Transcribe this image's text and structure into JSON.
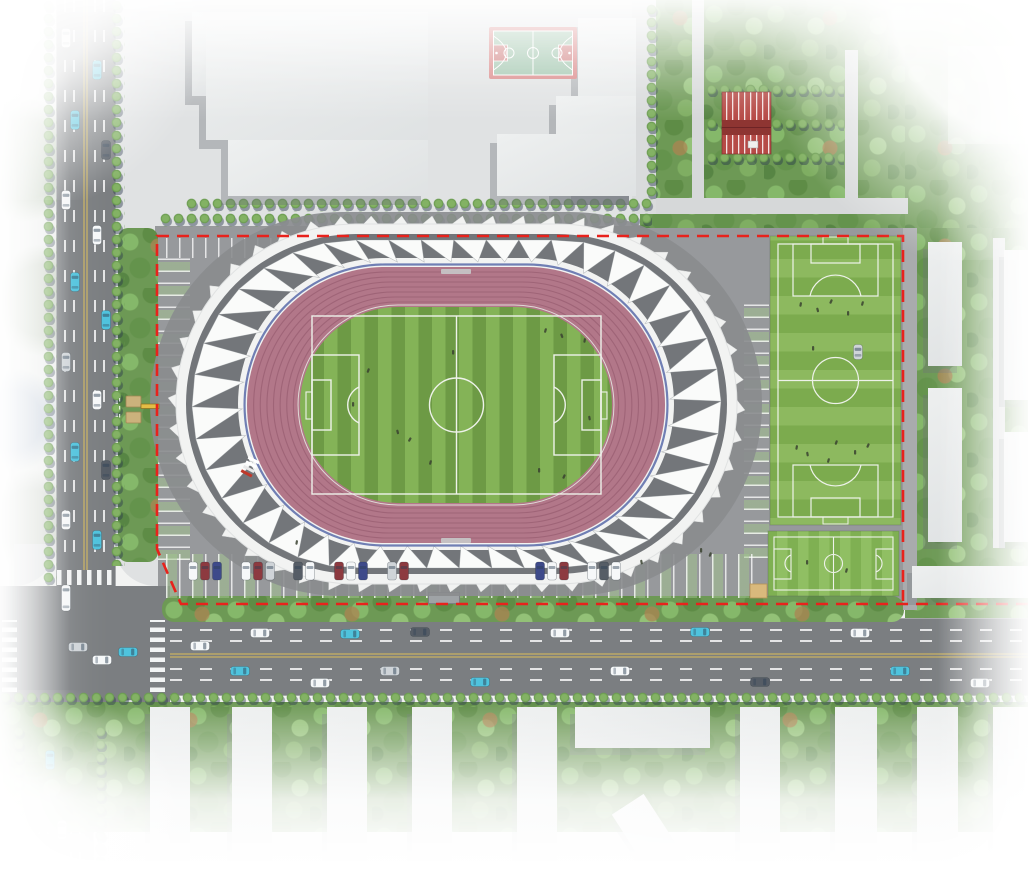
{
  "scene": {
    "type": "aerial-site-plan-rendering",
    "subject": "stadium sports complex with running track, practice pitches and surrounding streets",
    "visible_text": []
  },
  "colors": {
    "boundary_red": "#e8221c",
    "roof_white": "#f2f3f2",
    "roof_pleat": "#fafbfa",
    "roof_shadow": "#73767a",
    "stadium_surround": "#898c8e",
    "track_rose": "#b27789",
    "track_lane_line": "#9a5f73",
    "track_blue_edge": "#44589f",
    "field_green_light": "#84b357",
    "field_green_dark": "#6d9a45",
    "pitch_line_white": "#eef2ea",
    "practice_light": "#8db95f",
    "practice_dark": "#7cab4e",
    "small_field_light": "#90bf63",
    "small_field_dark": "#7fb052",
    "court_border_red": "#d98484",
    "court_surface_green": "#9ec4ab",
    "court_key_red": "#cf7d7d",
    "stand_red": "#b64a46",
    "stand_red_dark": "#8e3532",
    "road_asphalt": "#7b7e81",
    "plaza_gray": "#e0e2e3",
    "site_pavement": "#97999c",
    "building_gray": "#e9ebec",
    "median_yellow": "#ac9e6d",
    "car_cyan": "#4fc3dd",
    "car_white": "#f6f8f9",
    "car_dark": "#565d66",
    "car_red": "#8d3a40",
    "car_navy": "#3e4a8a",
    "car_silver": "#cfd4d8",
    "gate_tan": "#cbb27c",
    "hut_tan": "#d9b97c"
  },
  "features": {
    "stadium": {
      "name": "main stadium",
      "roof": "white pleated tensile roof",
      "track_lanes": 8,
      "infield": "striped soccer pitch with full markings"
    },
    "practice_field_large": "full-size practice pitch with horizontal mowing stripes and players",
    "practice_field_small": "small training pitch",
    "basketball_court": "green court with red border and keys",
    "red_stand": "small red striped stand near northeast gardens",
    "site_boundary": "red dashed property line",
    "parking": [
      "north strip stalls",
      "west column stalls",
      "east column stalls",
      "south row with parked cars"
    ],
    "roads": [
      "west avenue with median and lane dashes",
      "south avenue with median",
      "southwest signalized intersection with crosswalks"
    ],
    "context": [
      "campus buildings north",
      "residential slab buildings south and east",
      "dense tree belts",
      "garden paths northeast"
    ],
    "entrance_gate": "west gate with tan booths and barrier"
  },
  "counts": {
    "track_lanes": 8,
    "parked_cars_south_row": 19,
    "practice_fields": 2,
    "basketball_courts": 1
  }
}
